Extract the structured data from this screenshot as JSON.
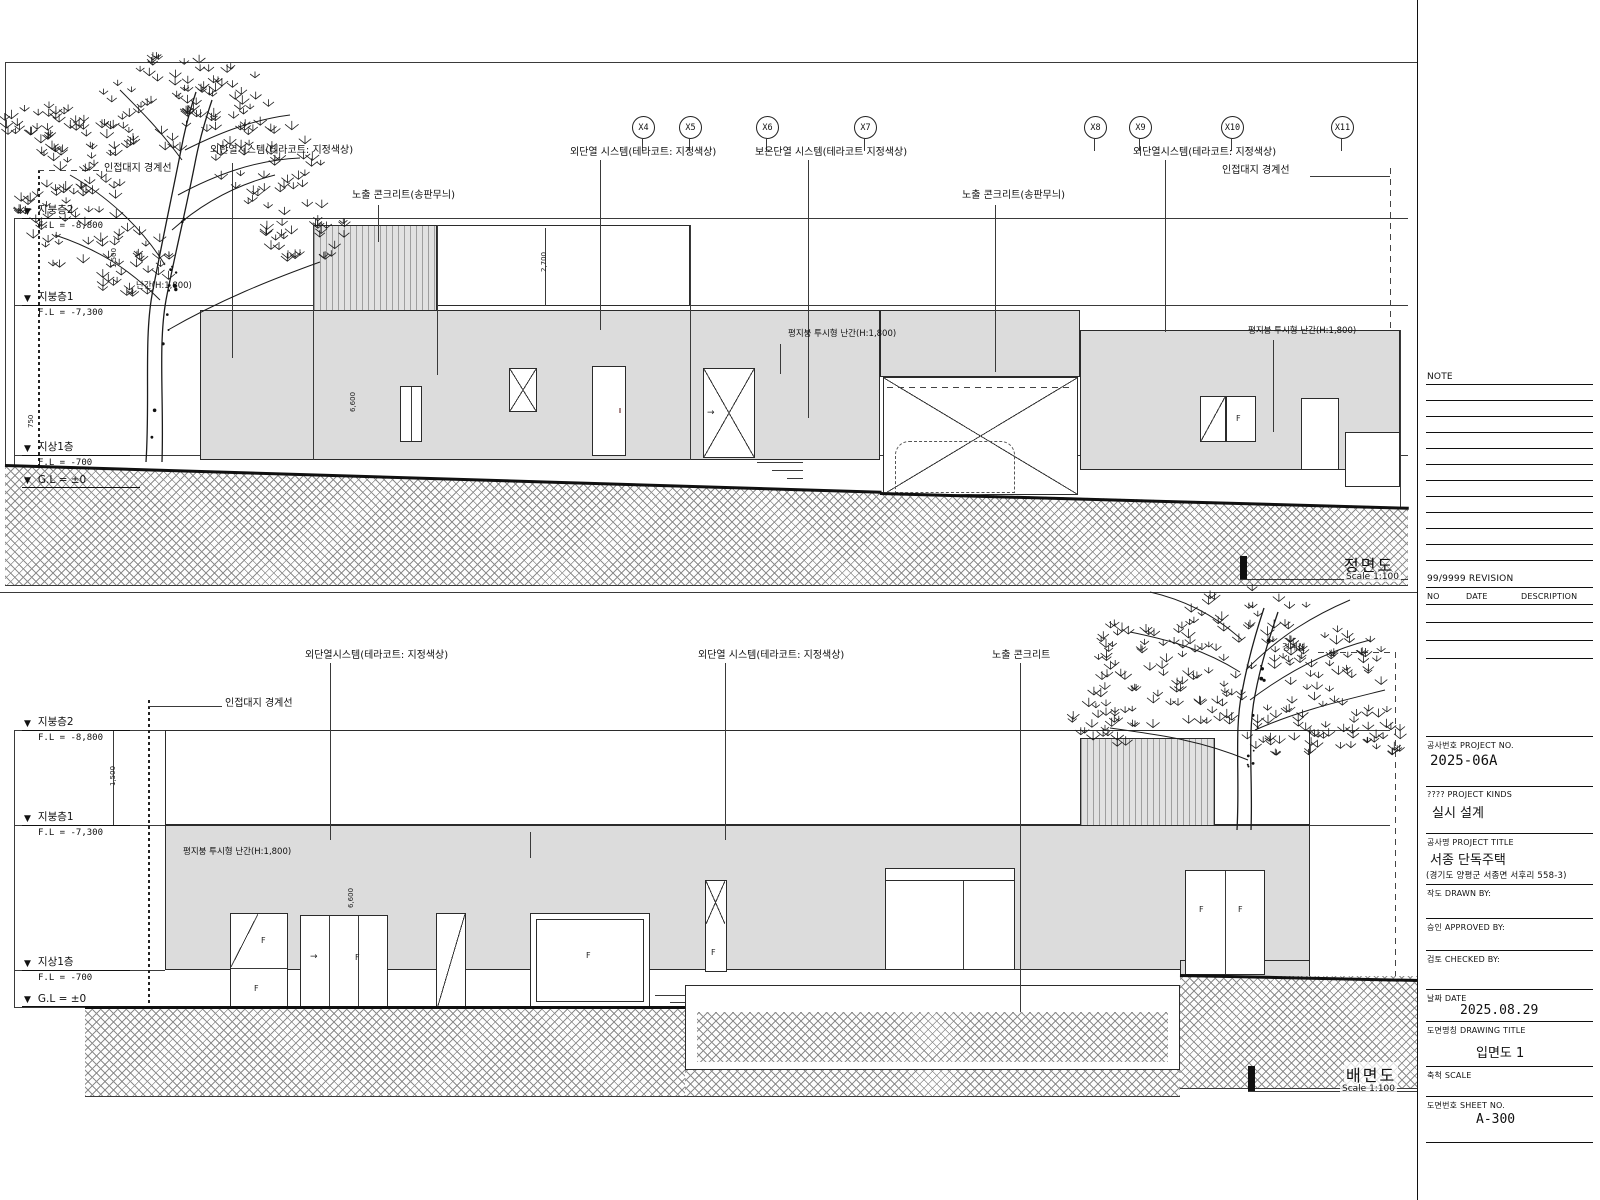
{
  "titleblock": {
    "note_label": "NOTE",
    "revision_label": "99/9999 REVISION",
    "rev_no": "NO",
    "rev_date": "DATE",
    "rev_desc": "DESCRIPTION",
    "project_no_label": "공사번호 PROJECT NO.",
    "project_no": "2025-06A",
    "project_kinds_label": "???? PROJECT KINDS",
    "project_kinds": "실시 설계",
    "project_title_label": "공사명 PROJECT TITLE",
    "project_title": "서종 단독주택",
    "project_address": "(경기도 양평군 서종면 서후리 558-3)",
    "drawn_by_label": "작도 DRAWN BY:",
    "approved_by_label": "승인 APPROVED BY:",
    "checked_by_label": "검토 CHECKED BY:",
    "date_label": "날짜 DATE",
    "date_value": "2025.08.29",
    "drawing_title_label": "도면명칭 DRAWING TITLE",
    "drawing_title": "입면도 1",
    "scale_label": "축척 SCALE",
    "sheet_no_label": "도면번호 SHEET NO.",
    "sheet_no": "A-300"
  },
  "marker_glyph": "▼",
  "arrow_glyph": "→",
  "grids": [
    "X4",
    "X5",
    "X6",
    "X7",
    "X8",
    "X9",
    "X10",
    "X11"
  ],
  "front": {
    "title": "정면도",
    "scale_text": "Scale 1:100",
    "levels": [
      {
        "name": "지붕층2",
        "fl": "F.L = -8,800"
      },
      {
        "name": "지붕층1",
        "fl": "F.L = -7,300"
      },
      {
        "name": "지상1층",
        "fl": "F.L = -700"
      },
      {
        "name": "G.L = ±0",
        "fl": ""
      }
    ],
    "labels": {
      "curtain_left": "외단열시스템(테라코트: 지정색상)",
      "boundary_left": "인접대지 경계선",
      "eifs1": "외단열 시스템(테라코트: 지정색상)",
      "eifs2": "보온단열 시스템(테라코트 지정색상)",
      "conc_left": "노출 콘크리트(송판무늬)",
      "conc_right": "노출 콘크리트(송판무늬)",
      "curtain_right": "외단열시스템(테라코트: 지정색상)",
      "boundary_right": "인접대지 경계선",
      "rail1": "평지붕 투시형 난간(H:1,800)",
      "rail2": "평지붕 투시형 난간(H:1,800)",
      "rail3": "난간(H:1,800)"
    },
    "dims": {
      "d1": "1,500",
      "d2": "2,700",
      "d3": "6,600",
      "d4": "750"
    },
    "window_mark": "F"
  },
  "rear": {
    "title": "배면도",
    "scale_text": "Scale 1:100",
    "levels": [
      {
        "name": "지붕층2",
        "fl": "F.L = -8,800"
      },
      {
        "name": "지붕층1",
        "fl": "F.L = -7,300"
      },
      {
        "name": "지상1층",
        "fl": "F.L = -700"
      },
      {
        "name": "G.L = ±0",
        "fl": ""
      }
    ],
    "labels": {
      "curtain": "외단열시스템(테라코트: 지정색상)",
      "eifs": "외단열 시스템(테라코트: 지정색상)",
      "conc": "노출 콘크리트",
      "boundary": "인접대지 경계선",
      "boundary2": "경계선",
      "rail": "평지붕 투시형 난간(H:1,800)"
    },
    "dims": {
      "d1": "1,500",
      "d2": "6,600"
    },
    "window_mark": "F"
  }
}
